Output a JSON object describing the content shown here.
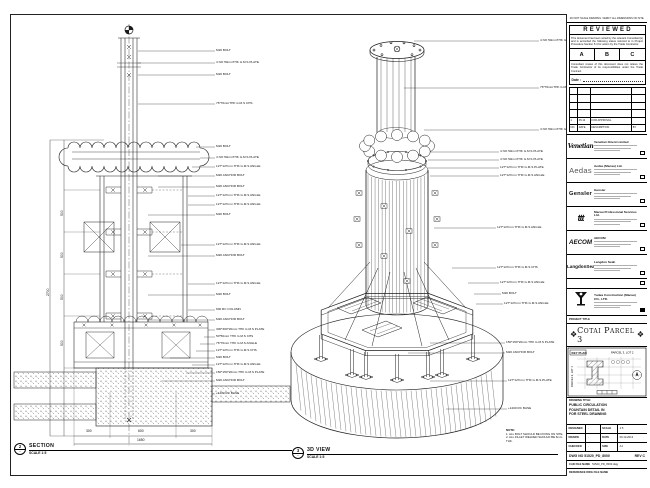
{
  "views": {
    "section": {
      "bubble_top": "2",
      "bubble_bottom": "-",
      "title": "SECTION",
      "scale": "SCALE 1:5"
    },
    "three_d": {
      "bubble_top": "3",
      "bubble_bottom": "-",
      "title": "3D VIEW",
      "scale": "SCALE 1:5"
    }
  },
  "note": {
    "title": "NOTE:",
    "lines": [
      "1. ALL BOLT SHOULD BE FIXING ON SITE.",
      "2. ALL FILLET WELDED SHOULD BE 6mm THK."
    ]
  },
  "left_view": {
    "annotations": [
      {
        "t": "M20 BOLT",
        "x": 216,
        "y": 51,
        "lx": 138
      },
      {
        "t": "4 NO 50mmTHK G.M.S PLATE",
        "x": 216,
        "y": 63,
        "lx": 138
      },
      {
        "t": "M20 BOLT",
        "x": 216,
        "y": 75,
        "lx": 138
      },
      {
        "t": "76*76mmTHK G.M.S CHS",
        "x": 216,
        "y": 104,
        "lx": 138
      },
      {
        "t": "M20 BOLT",
        "x": 216,
        "y": 147,
        "lx": 196
      },
      {
        "t": "4 NO 50mmTHK G.M.S PLATE",
        "x": 216,
        "y": 158,
        "lx": 200
      },
      {
        "t": "127*127mm THK G.M.S ANGLE",
        "x": 216,
        "y": 167,
        "lx": 192
      },
      {
        "t": "M20 ANCHOR BOLT",
        "x": 216,
        "y": 176,
        "lx": 158
      },
      {
        "t": "M20 ANCHOR BOLT",
        "x": 216,
        "y": 187,
        "lx": 158
      },
      {
        "t": "127*127mm THK G.M.S ANGLE",
        "x": 216,
        "y": 196,
        "lx": 188
      },
      {
        "t": "127*127mm THK G.M.S ANGLE",
        "x": 216,
        "y": 205,
        "lx": 188
      },
      {
        "t": "M20 BOLT",
        "x": 216,
        "y": 215,
        "lx": 148
      },
      {
        "t": "127*127mm THK G.M.S ANGLE",
        "x": 216,
        "y": 245,
        "lx": 181
      },
      {
        "t": "M20 ANCHOR BOLT",
        "x": 216,
        "y": 256,
        "lx": 148
      },
      {
        "t": "127*127mm THK G.M.S ANGLE",
        "x": 216,
        "y": 284,
        "lx": 188
      },
      {
        "t": "M20 BOLT",
        "x": 216,
        "y": 295,
        "lx": 148
      },
      {
        "t": "600 RC COLUMN",
        "x": 216,
        "y": 310,
        "lx": 188
      },
      {
        "t": "M20 ANCHOR BOLT",
        "x": 216,
        "y": 320,
        "lx": 148
      },
      {
        "t": "300*300*20mm THK G.M.S PLATE",
        "x": 216,
        "y": 330,
        "lx": 208
      },
      {
        "t": "50*50mm THK G.M.S CHS",
        "x": 216,
        "y": 337,
        "lx": 204
      },
      {
        "t": "76*76mm THK G.M.S ANGLE",
        "x": 216,
        "y": 344,
        "lx": 200
      },
      {
        "t": "127*127mm THK G.M.S CHS",
        "x": 216,
        "y": 351,
        "lx": 196
      },
      {
        "t": "M20 BOLT",
        "x": 216,
        "y": 358,
        "lx": 170
      },
      {
        "t": "127*127mm THK G.M.S ANGLE",
        "x": 216,
        "y": 365,
        "lx": 192
      },
      {
        "t": "150*150*20mm THK G.M.S PLATE",
        "x": 216,
        "y": 373,
        "lx": 186
      },
      {
        "t": "M20 ANCHOR BOLT",
        "x": 216,
        "y": 381,
        "lx": 162
      },
      {
        "t": "+1200 RC BASE",
        "x": 216,
        "y": 394,
        "lx": 212
      }
    ],
    "dim_labels": [
      {
        "t": "500",
        "x": 61,
        "y": 216,
        "r": -90
      },
      {
        "t": "500",
        "x": 61,
        "y": 258,
        "r": -90
      },
      {
        "t": "500",
        "x": 61,
        "y": 300,
        "r": -90
      },
      {
        "t": "500",
        "x": 61,
        "y": 346,
        "r": -90
      },
      {
        "t": "2700",
        "x": 47,
        "y": 296,
        "r": -90
      },
      {
        "t": "300",
        "x": 86,
        "y": 430,
        "r": 0
      },
      {
        "t": "600",
        "x": 138,
        "y": 430,
        "r": 0
      },
      {
        "t": "300",
        "x": 190,
        "y": 430,
        "r": 0
      },
      {
        "t": "1650",
        "x": 137,
        "y": 439,
        "r": 0
      }
    ]
  },
  "right_view": {
    "annotations": [
      {
        "t": "4 NO 50mmTHK G.M.S PLATE",
        "x": 540,
        "y": 41,
        "lx": 414
      },
      {
        "t": "76*76mmTHK G.M.S CHS",
        "x": 540,
        "y": 88,
        "lx": 404
      },
      {
        "t": "4 NO 50mmTHK G.M.S PLATE",
        "x": 540,
        "y": 130,
        "lx": 424
      },
      {
        "t": "4 NO 50mmTHK G.M.S PLATE",
        "x": 500,
        "y": 152,
        "lx": 430
      },
      {
        "t": "4 NO 50mmTHK G.M.S PLATE",
        "x": 500,
        "y": 160,
        "lx": 428
      },
      {
        "t": "127*127mm THK G.M.S PLATE",
        "x": 500,
        "y": 168,
        "lx": 428
      },
      {
        "t": "127*127mm THK G.M.S ANGLE",
        "x": 500,
        "y": 176,
        "lx": 430
      },
      {
        "t": "127*127mm THK G.M.S ANGLE",
        "x": 497,
        "y": 228,
        "lx": 434
      },
      {
        "t": "127*127mm THK G.M.S CHS",
        "x": 497,
        "y": 268,
        "lx": 452
      },
      {
        "t": "127*127mm THK G.M.S ANGLE",
        "x": 500,
        "y": 283,
        "lx": 468
      },
      {
        "t": "M20 BOLT",
        "x": 502,
        "y": 294,
        "lx": 474
      },
      {
        "t": "127*127mm THK G.M.S ANGLE",
        "x": 504,
        "y": 304,
        "lx": 476
      },
      {
        "t": "150*150*20mm THK G.M.S PLATE",
        "x": 506,
        "y": 343,
        "lx": 430
      },
      {
        "t": "M20 ANCHOR BOLT",
        "x": 506,
        "y": 353,
        "lx": 408
      },
      {
        "t": "127*127mm THK G.M.S PLATE",
        "x": 508,
        "y": 381,
        "lx": 430
      },
      {
        "t": "+1200 RC BASE",
        "x": 508,
        "y": 409,
        "lx": 446
      }
    ]
  },
  "title_block": {
    "top_note": "DO NOT SCALE DRAWING. VERIFY ALL DIMENSIONS ON SITE.",
    "reviewed": {
      "title": "REVIEWED",
      "body": "This document has been noted by the relevant Consultant(s) and is accorded the following status referred  to  in Project Procedure Section 5.4 for action by the Trade Contractor.",
      "options": [
        "A",
        "B",
        "C"
      ],
      "footer": "Consultant review of this document does not relieve the Trade Contractor of its responsibilities under the Trade Contract.",
      "date_label": "Date :"
    },
    "revision_table": {
      "rows": [
        {
          "c1": "",
          "c2": "",
          "c3": "",
          "c4": ""
        },
        {
          "c1": "",
          "c2": "",
          "c3": "",
          "c4": ""
        },
        {
          "c1": "",
          "c2": "",
          "c3": "",
          "c4": ""
        },
        {
          "c1": "",
          "c2": "",
          "c3": "",
          "c4": ""
        },
        {
          "c1": "1",
          "c2": "05.13",
          "c3": "FOR APPROVAL",
          "c4": ""
        },
        {
          "c1": "NO.",
          "c2": "DATE",
          "c3": "DESCRIPTION",
          "c4": "BY"
        }
      ]
    },
    "companies": [
      {
        "logo": "Venetian",
        "style": "venetian",
        "name": "Venetian Orient Limited"
      },
      {
        "logo": "Aedas",
        "style": "aedas",
        "name": "Aedas (Macau) Ltd."
      },
      {
        "logo": "Gensler",
        "style": "gensler",
        "name": "Gensler"
      },
      {
        "logo": "ttt",
        "style": "mps",
        "name": "Macau Professional Services Ltd."
      },
      {
        "logo": "AECOM",
        "style": "aecom",
        "name": "AECOM"
      },
      {
        "logo": "LangdonSeah",
        "style": "langdon",
        "name": "Langdon Seah"
      }
    ],
    "contractor": {
      "name": "Yudea Construction (Macau) CO., LTD."
    },
    "project": {
      "label": "PROJECT TITLE",
      "title": "Cotai Parcel 3",
      "ornament": "❖"
    },
    "key_plan": {
      "label": "KEY PLAN",
      "lot_right": "PARCEL 3, LOT 2",
      "lot_left": "PARCEL 3, LOT 1"
    },
    "drawing_title": {
      "label": "DRAWING TITLE:",
      "lines": [
        "PUBLIC CIRCULATION",
        "FOUNTAIN DETAIL IN",
        "FOR STEEL DRAWING"
      ]
    },
    "approval_rows": [
      {
        "k": "DESIGNED",
        "v": "-",
        "k2": "SCALE",
        "v2": "1:5"
      },
      {
        "k": "DRAWN",
        "v": "-",
        "k2": "DATE",
        "v2": "09.10.2013"
      },
      {
        "k": "CHECKED",
        "v": "-",
        "k2": "SIZE",
        "v2": "A1"
      }
    ],
    "dwg": {
      "label": "DWG NO",
      "number": "51520_PD_8000",
      "rev_label": "REV",
      "rev": "C"
    },
    "cad_file": {
      "label": "CAD FILE NAME",
      "value": "51520_PD_8000.dwg"
    },
    "reference": {
      "label": "REFERENCE DWG FILE NAME"
    }
  }
}
